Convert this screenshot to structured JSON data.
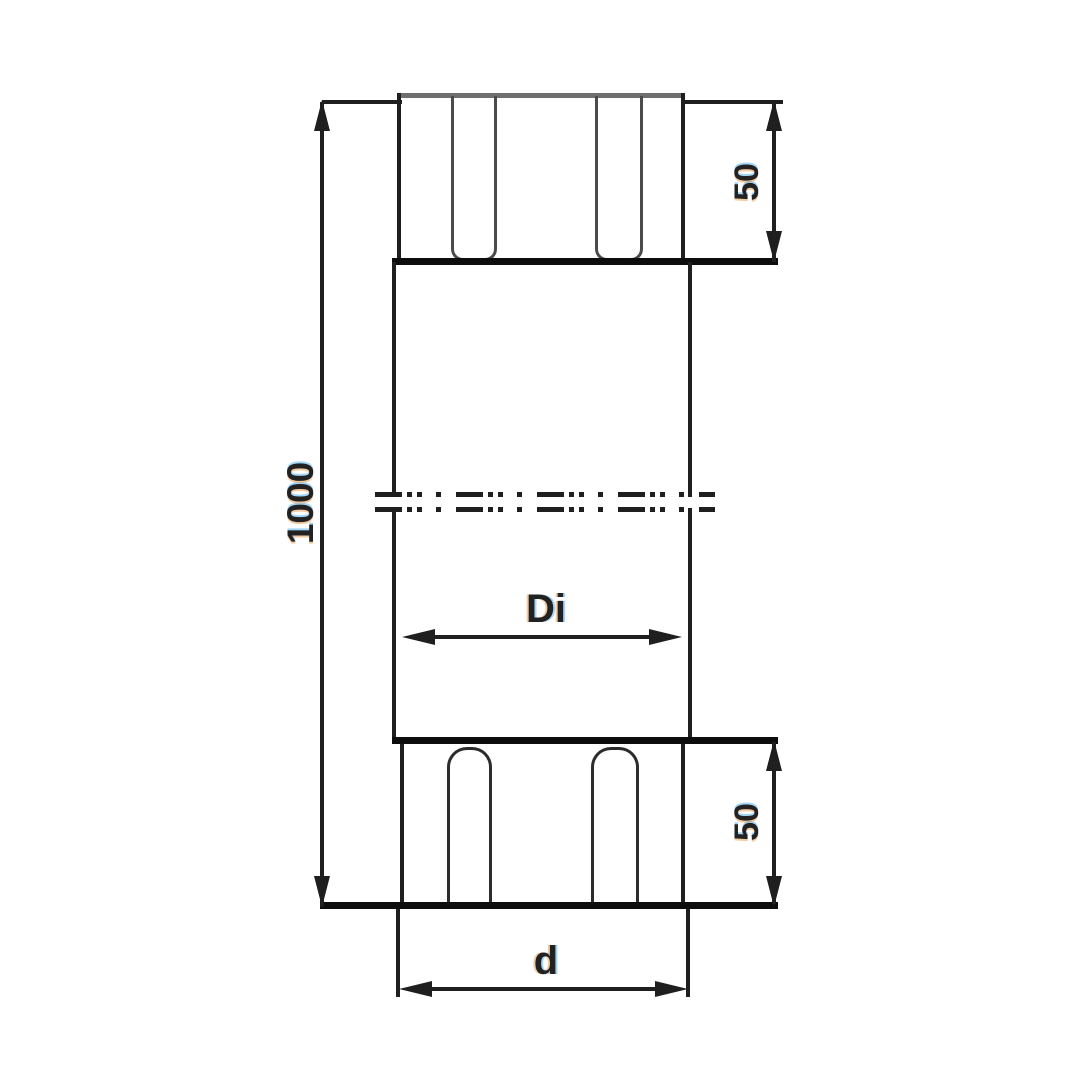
{
  "drawing": {
    "labels": {
      "overall_length": "1000",
      "top_collar_height": "50",
      "bottom_collar_height": "50",
      "inner_diameter": "Di",
      "outer_diameter": "d"
    },
    "colors": {
      "ink": "#1f1f1f",
      "thick": "#0d0d0d",
      "gray_edge": "#6f6f6f",
      "bead": "#4b4b4b",
      "background": "#ffffff"
    }
  }
}
